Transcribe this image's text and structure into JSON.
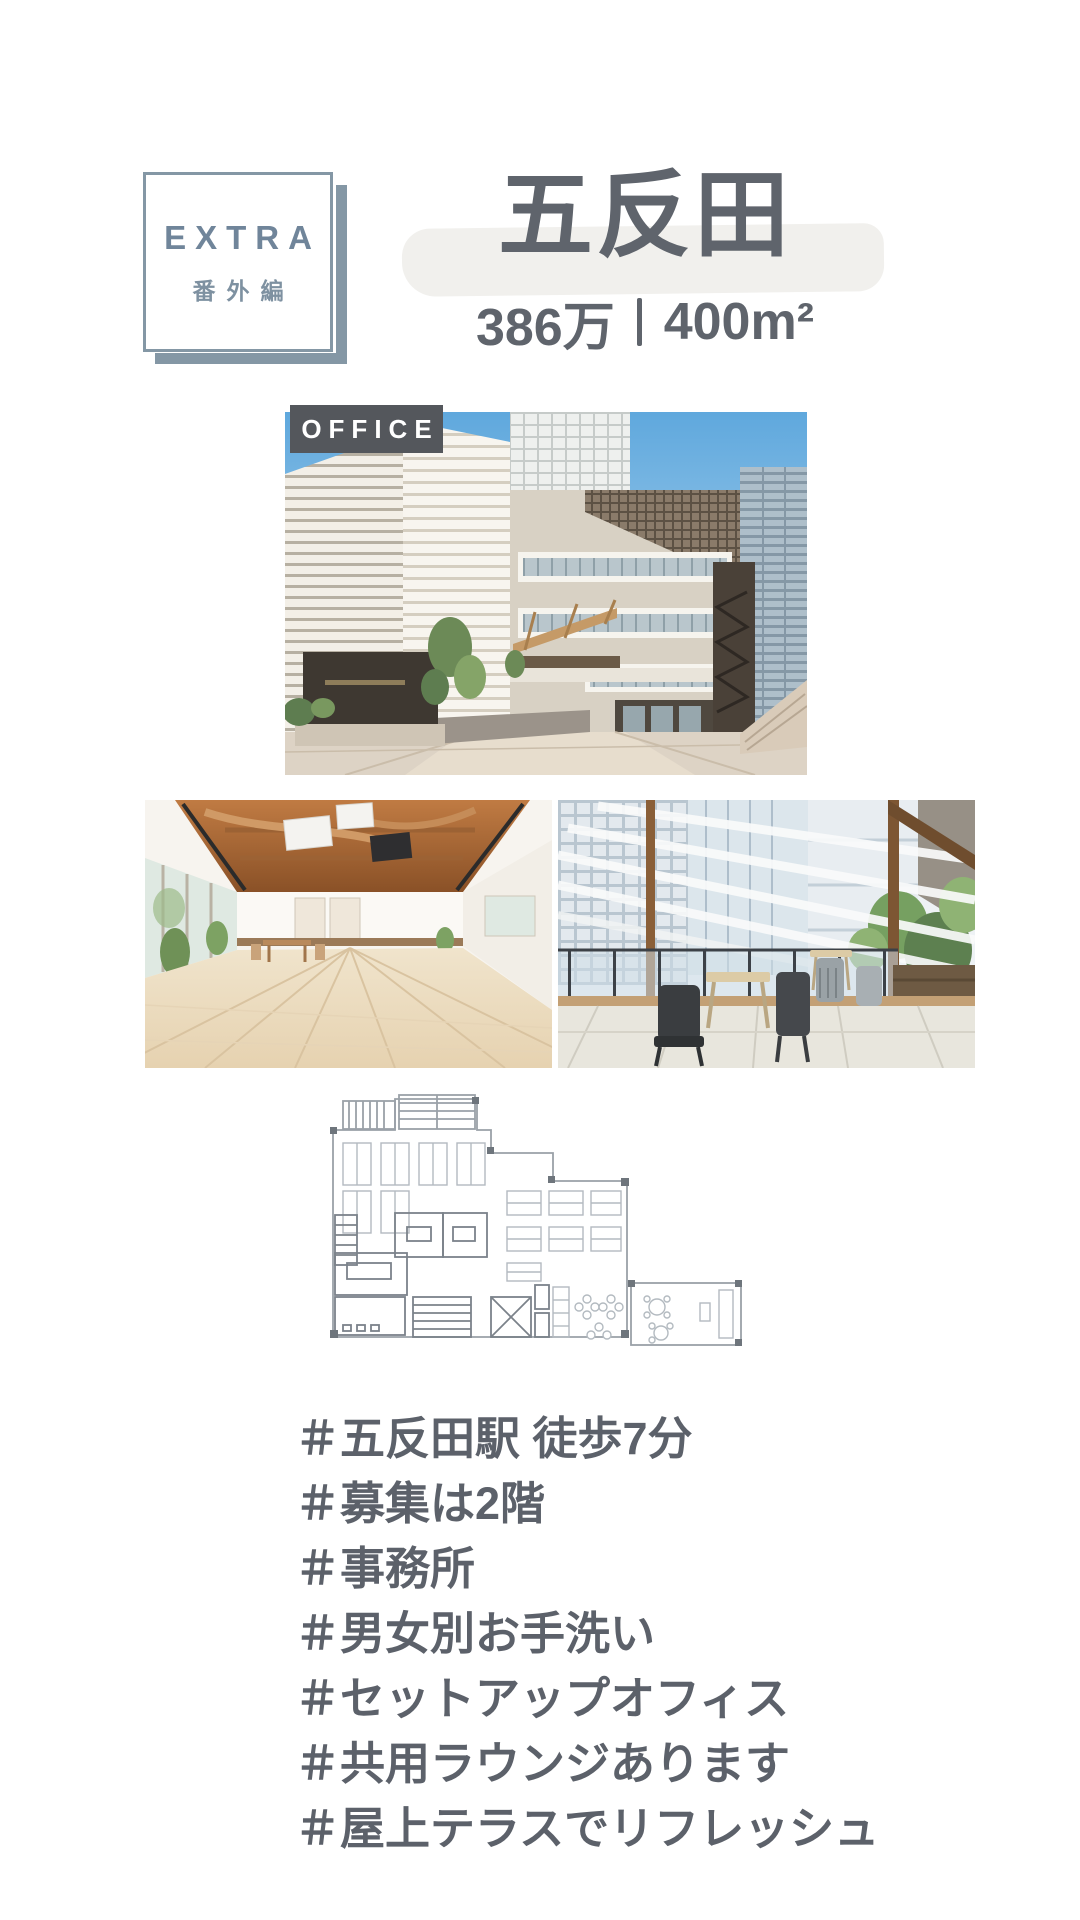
{
  "badge": {
    "line1": "EXTRA",
    "line2": "番外編"
  },
  "header": {
    "title": "五反田",
    "price": "386万",
    "area": "400m²"
  },
  "photos": {
    "office_label": "OFFICE"
  },
  "hashtags": [
    "＃五反田駅 徒歩7分",
    "＃募集は2階",
    "＃事務所",
    "＃男女別お手洗い",
    "＃セットアップオフィス",
    "＃共用ラウンジあります",
    "＃屋上テラスでリフレッシュ"
  ],
  "colors": {
    "accent_blue_gray": "#8497a5",
    "badge_text": "#70859a",
    "title_text": "#5f646c",
    "hashtag_text": "#5c616a",
    "title_highlight": "#f1f0ed",
    "office_tag_bg": "#54575c",
    "background": "#ffffff"
  }
}
